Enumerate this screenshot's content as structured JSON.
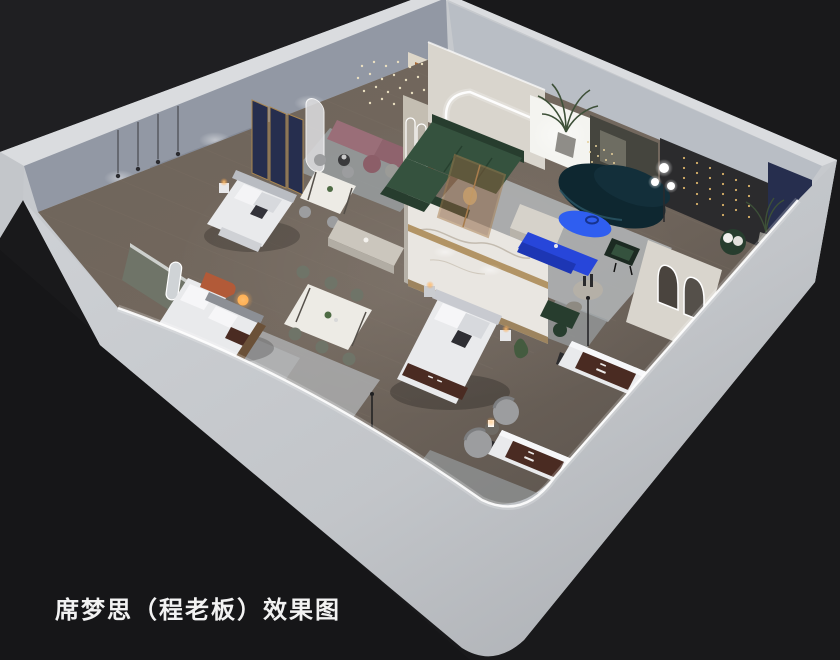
{
  "caption": "席梦思（程老板）效果图",
  "palette": {
    "bg": "#19191b",
    "bg_top": "#202124",
    "bg_bottom": "#161618",
    "rim": "#c6c9cd",
    "band_top": "#dadcdf",
    "wall_back_left": "#9298a4",
    "wall_back_right": "#b9bec5",
    "wall_panel_dark": "#7e8492",
    "wall_cream": "#d9d5cd",
    "wall_olive": "#45453e",
    "wall_charcoal": "#2b2b2d",
    "wall_navy": "#262e4e",
    "panel_backlit": "#f4f4f0",
    "marble": "#e9e6e1",
    "marble_gold": "#a8854f",
    "floor_wood": "#695f56",
    "rug_light": "#b3b6b8",
    "rug_mid": "#9aa0a3",
    "green_sofa": "#35523e",
    "green_dark": "#273d2e",
    "teal_sofa": "#0e2730",
    "blue_table": "#2f5ef0",
    "blue_console": "#2746da",
    "mauve_bench": "#9a6e78",
    "terracotta": "#b25a38",
    "mattress_white": "#e9eaec",
    "mattress_brown": "#4a2b22",
    "gray_chair": "#9c9d9f",
    "cream_bench": "#cbc6bd",
    "chair_dark": "#6f7468",
    "lamp_warm": "#ffb357",
    "led_white": "#ffffff",
    "string_gold": "#d9b269",
    "caption_color": "#f2f2f2"
  }
}
